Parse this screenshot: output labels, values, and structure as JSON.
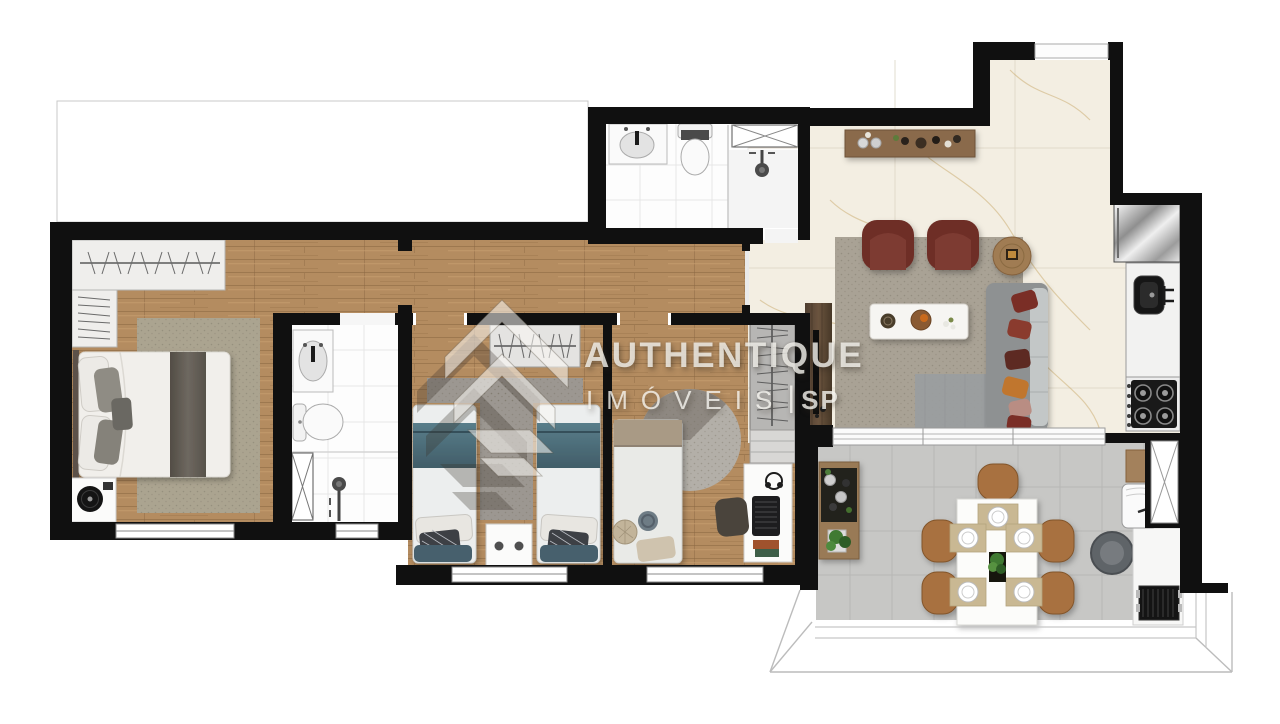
{
  "watermark": {
    "brand": "AUTHENTIQUE",
    "line2_word": "IMÓVEIS",
    "line2_sep": "|",
    "line2_suffix": "SP"
  },
  "palette": {
    "watermark-text": "rgba(250,248,244,0.78)",
    "wall": "#101010",
    "wood-floor": "#b48c60",
    "marble-floor": "#f3eee2",
    "bathroom-floor": "#fdfdfd",
    "balcony-floor": "#c7c7c5",
    "rug": "#a8a193",
    "armchair-accent": "#6e2f28",
    "sofa": "#8e9192",
    "bed-blanket-teal": "#4d6e7b",
    "dining-chair-leather": "#a8713f",
    "wood-furniture": "#8a6a4c"
  },
  "floorplan": {
    "type": "apartment-floor-plan",
    "rooms": [
      {
        "id": "master-bedroom",
        "floor": "wood",
        "furniture": [
          "wardrobe",
          "double-bed",
          "area-rug",
          "turntable-side-table",
          "window"
        ]
      },
      {
        "id": "master-bathroom",
        "floor": "white-tile",
        "furniture": [
          "vanity-sink",
          "toilet",
          "shower-box",
          "shower-head",
          "window"
        ]
      },
      {
        "id": "hallway",
        "floor": "wood",
        "furniture": []
      },
      {
        "id": "social-bathroom",
        "floor": "white-tile",
        "furniture": [
          "vanity-sink",
          "toilet",
          "shower-box",
          "shower-head"
        ]
      },
      {
        "id": "bedroom-2",
        "floor": "wood",
        "furniture": [
          "wardrobe",
          "single-bed",
          "single-bed",
          "nightstand",
          "rug",
          "window"
        ]
      },
      {
        "id": "bedroom-3",
        "floor": "wood",
        "furniture": [
          "wardrobe",
          "single-bed",
          "round-rug",
          "desk",
          "laptop",
          "desk-chair",
          "window"
        ]
      },
      {
        "id": "living-room",
        "floor": "marble",
        "furniture": [
          "sideboard",
          "armchair",
          "armchair",
          "round-side-table",
          "coffee-table",
          "area-rug",
          "sofa-with-pillows",
          "tv-panel",
          "sliding-glass-door",
          "entry-door"
        ]
      },
      {
        "id": "kitchen",
        "floor": "marble",
        "furniture": [
          "refrigerator",
          "counter-with-sink",
          "gas-cooktop-4-burners",
          "service-door"
        ]
      },
      {
        "id": "balcony-gourmet",
        "floor": "gray-tile",
        "furniture": [
          "buffet-cabinet",
          "plant",
          "dining-table",
          "dining-chair",
          "dining-chair",
          "dining-chair",
          "dining-chair",
          "dining-chair",
          "place-settings-x5",
          "laundry-sink",
          "barbecue-grill",
          "railing"
        ]
      }
    ],
    "counts": {
      "bedrooms": 3,
      "bathrooms": 2,
      "dining-chairs": 5,
      "living-armchairs": 2,
      "cooktop-burners": 4
    }
  }
}
